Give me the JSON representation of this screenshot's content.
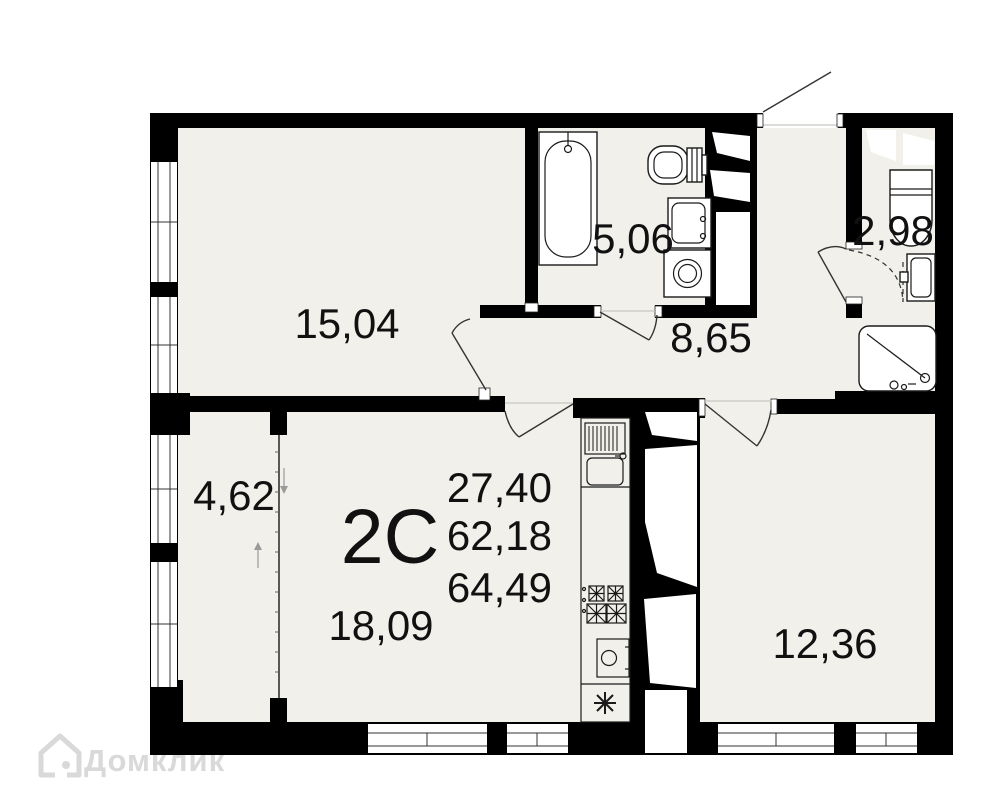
{
  "plan": {
    "type_label": "2С",
    "areas": [
      "27,40",
      "62,18",
      "64,49"
    ],
    "rooms": [
      {
        "key": "room-15",
        "area": "15,04"
      },
      {
        "key": "bathroom",
        "area": "5,06"
      },
      {
        "key": "hallway",
        "area": "8,65"
      },
      {
        "key": "shower-room",
        "area": "2,98"
      },
      {
        "key": "balcony",
        "area": "4,62"
      },
      {
        "key": "living-kitchen",
        "area": "18,09"
      },
      {
        "key": "bedroom",
        "area": "12,36"
      }
    ],
    "symbols": {
      "kitchen_vent_star": "✳",
      "balcony_arrow_down": "↓",
      "balcony_arrow_up": "↑"
    }
  },
  "watermark": {
    "brand": "Домклик"
  },
  "colors": {
    "floor": "#f2f0ea",
    "wall": "#000000",
    "outline": "#1a1a1a",
    "watermark": "#d9d9d9",
    "background": "#ffffff"
  }
}
